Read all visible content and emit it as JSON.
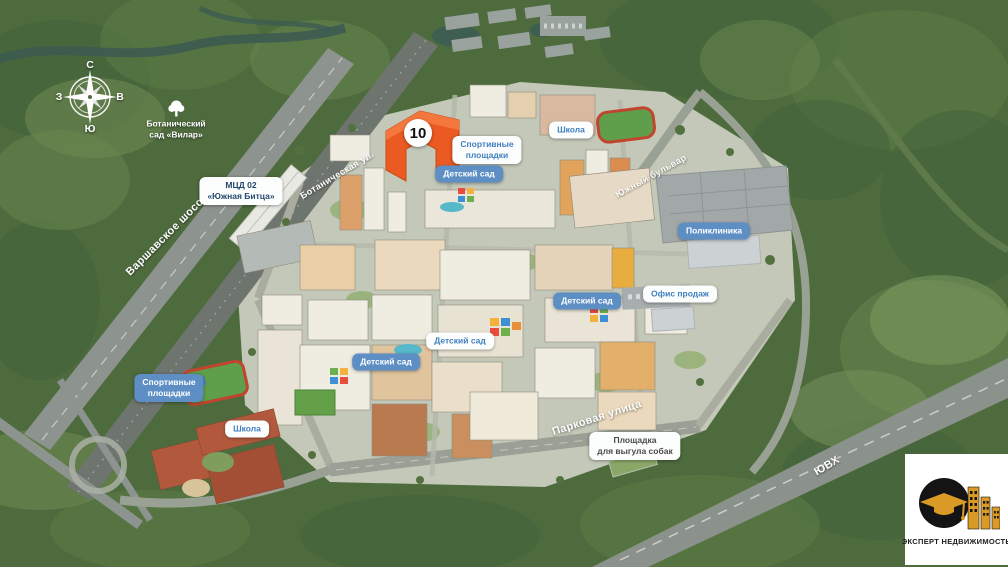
{
  "colors": {
    "highlight_building": "#e85a1f",
    "pill_blue_bg": "#5d8fc5",
    "pill_blue_text": "#4080bf"
  },
  "compass": {
    "north": "С",
    "east": "В",
    "south": "Ю",
    "west": "З"
  },
  "highlight": {
    "building_number": "10"
  },
  "pois": [
    {
      "id": "botanical-garden",
      "lines": [
        "Ботанический",
        "сад «Вилар»"
      ]
    },
    {
      "id": "mcd-station",
      "lines": [
        "МЦД 02",
        "«Южная Битца»"
      ]
    },
    {
      "id": "sports-grounds-north",
      "lines": [
        "Спортивные",
        "площадки"
      ]
    },
    {
      "id": "kindergarten-north",
      "lines": [
        "Детский сад"
      ]
    },
    {
      "id": "school-north",
      "lines": [
        "Школа"
      ]
    },
    {
      "id": "polyclinic",
      "lines": [
        "Поликлиника"
      ]
    },
    {
      "id": "kindergarten-east",
      "lines": [
        "Детский сад"
      ]
    },
    {
      "id": "sales-office",
      "lines": [
        "Офис продаж"
      ]
    },
    {
      "id": "kindergarten-center",
      "lines": [
        "Детский сад"
      ]
    },
    {
      "id": "kindergarten-west",
      "lines": [
        "Детский сад"
      ]
    },
    {
      "id": "sports-grounds-south",
      "lines": [
        "Спортивные",
        "площадки"
      ]
    },
    {
      "id": "school-south",
      "lines": [
        "Школа"
      ]
    },
    {
      "id": "dog-walking-area",
      "lines": [
        "Площадка",
        "для выгула собак"
      ]
    }
  ],
  "streets": [
    {
      "id": "varshavskoe-shosse",
      "text": "Варшавское шоссе"
    },
    {
      "id": "botanicheskaya-ul",
      "text": "Ботаническая ул."
    },
    {
      "id": "yuzhny-bulvar",
      "text": "Южный бульвар"
    },
    {
      "id": "parkovaya-ulitsa",
      "text": "Парковая улица"
    },
    {
      "id": "yuvh",
      "text": "ЮВХ"
    }
  ],
  "logo": {
    "text": "ЭКСПЕРТ НЕДВИЖИМОСТЬ"
  }
}
